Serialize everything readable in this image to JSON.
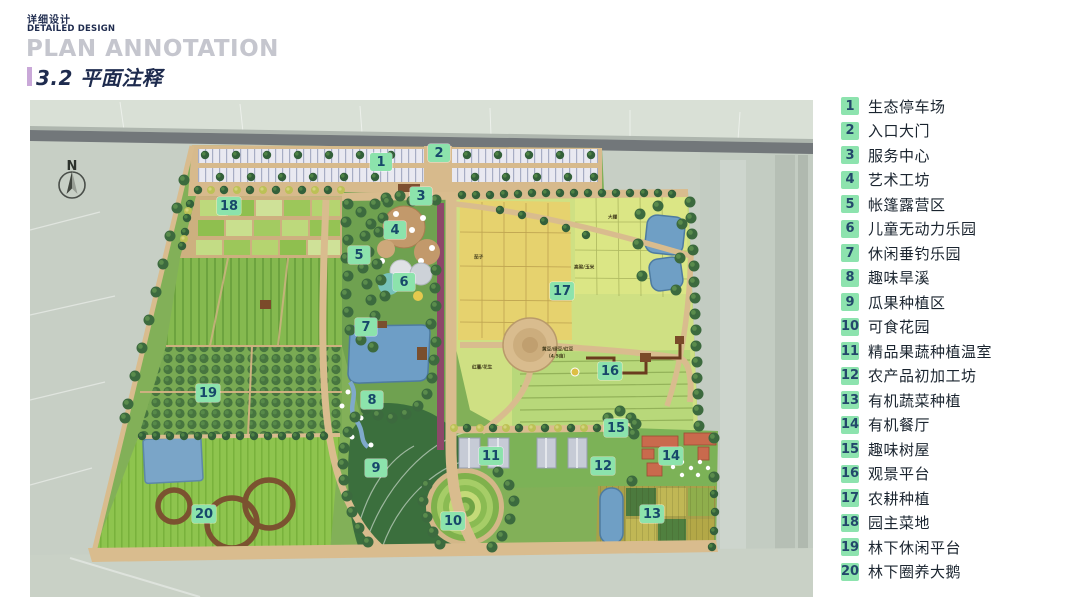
{
  "header": {
    "subtitle_cn": "详细设计",
    "subtitle_en": "DETAILED DESIGN",
    "title_en": "PLAN ANNOTATION",
    "section_title": "3.2 平面注释"
  },
  "plan": {
    "compass_label": "N",
    "markers": [
      {
        "num": "1",
        "x": 351,
        "y": 62
      },
      {
        "num": "2",
        "x": 409,
        "y": 53
      },
      {
        "num": "3",
        "x": 391,
        "y": 96
      },
      {
        "num": "4",
        "x": 365,
        "y": 130
      },
      {
        "num": "5",
        "x": 329,
        "y": 155
      },
      {
        "num": "6",
        "x": 374,
        "y": 182
      },
      {
        "num": "7",
        "x": 336,
        "y": 227
      },
      {
        "num": "8",
        "x": 342,
        "y": 300
      },
      {
        "num": "9",
        "x": 346,
        "y": 368
      },
      {
        "num": "10",
        "x": 423,
        "y": 421
      },
      {
        "num": "11",
        "x": 461,
        "y": 356
      },
      {
        "num": "12",
        "x": 573,
        "y": 366
      },
      {
        "num": "13",
        "x": 622,
        "y": 414
      },
      {
        "num": "14",
        "x": 641,
        "y": 356
      },
      {
        "num": "15",
        "x": 586,
        "y": 328
      },
      {
        "num": "16",
        "x": 580,
        "y": 271
      },
      {
        "num": "17",
        "x": 532,
        "y": 191
      },
      {
        "num": "18",
        "x": 199,
        "y": 106
      },
      {
        "num": "19",
        "x": 178,
        "y": 293
      },
      {
        "num": "20",
        "x": 174,
        "y": 414
      }
    ],
    "field_labels": [
      {
        "text": "茄子",
        "x": 444,
        "y": 154
      },
      {
        "text": "高粱/玉米",
        "x": 544,
        "y": 164
      },
      {
        "text": "大棚",
        "x": 578,
        "y": 114
      },
      {
        "text": "红薯/花生",
        "x": 442,
        "y": 264
      },
      {
        "text": "黄豆/绿豆/红豆",
        "x": 512,
        "y": 246
      },
      {
        "text": "（4.5亩）",
        "x": 516,
        "y": 253
      }
    ]
  },
  "legend": {
    "items": [
      {
        "num": "1",
        "label": "生态停车场"
      },
      {
        "num": "2",
        "label": "入口大门"
      },
      {
        "num": "3",
        "label": "服务中心"
      },
      {
        "num": "4",
        "label": "艺术工坊"
      },
      {
        "num": "5",
        "label": "帐篷露营区"
      },
      {
        "num": "6",
        "label": "儿童无动力乐园"
      },
      {
        "num": "7",
        "label": "休闲垂钓乐园"
      },
      {
        "num": "8",
        "label": "趣味旱溪"
      },
      {
        "num": "9",
        "label": "瓜果种植区"
      },
      {
        "num": "10",
        "label": "可食花园"
      },
      {
        "num": "11",
        "label": "精品果蔬种植温室"
      },
      {
        "num": "12",
        "label": "农产品初加工坊"
      },
      {
        "num": "13",
        "label": "有机蔬菜种植"
      },
      {
        "num": "14",
        "label": "有机餐厅"
      },
      {
        "num": "15",
        "label": "趣味树屋"
      },
      {
        "num": "16",
        "label": "观景平台"
      },
      {
        "num": "17",
        "label": "农耕种植"
      },
      {
        "num": "18",
        "label": "园主菜地"
      },
      {
        "num": "19",
        "label": "林下休闲平台"
      },
      {
        "num": "20",
        "label": "林下圈养大鹅"
      }
    ]
  },
  "colors": {
    "badge_bg": "#8de3ae",
    "badge_text": "#23486b",
    "title_navy": "#1e2b4e",
    "title_gray": "#c5c6ce",
    "accent_purple": "#c9a8d8",
    "path_tan": "#d9bc8e",
    "water_blue": "#6f9fc5"
  }
}
